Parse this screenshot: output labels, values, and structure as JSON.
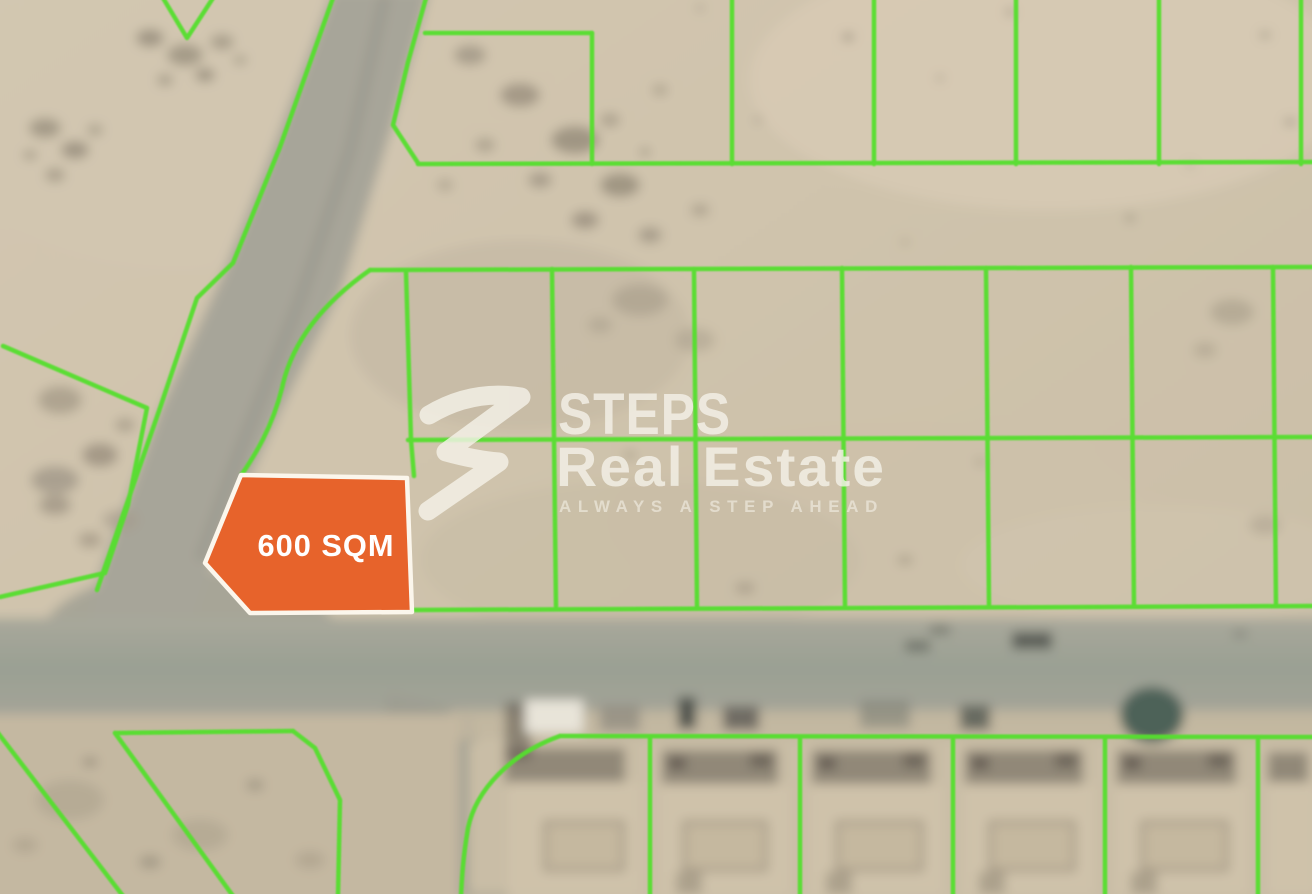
{
  "map": {
    "description_label": "Satellite land-plot map with boundary overlay"
  },
  "badge": {
    "label": "600 SQM"
  },
  "watermark": {
    "brand_top": "STEPS",
    "brand_bottom": "Real Estate",
    "tagline": "ALWAYS A STEP AHEAD"
  },
  "colors": {
    "plot_boundary_green": "#55DF2D",
    "highlight_orange": "#E7632B",
    "badge_border": "#FBF6EC",
    "watermark_white": "#F4F1E8",
    "sand_base": "#CFC3AC",
    "road_gray": "#A3A296"
  }
}
